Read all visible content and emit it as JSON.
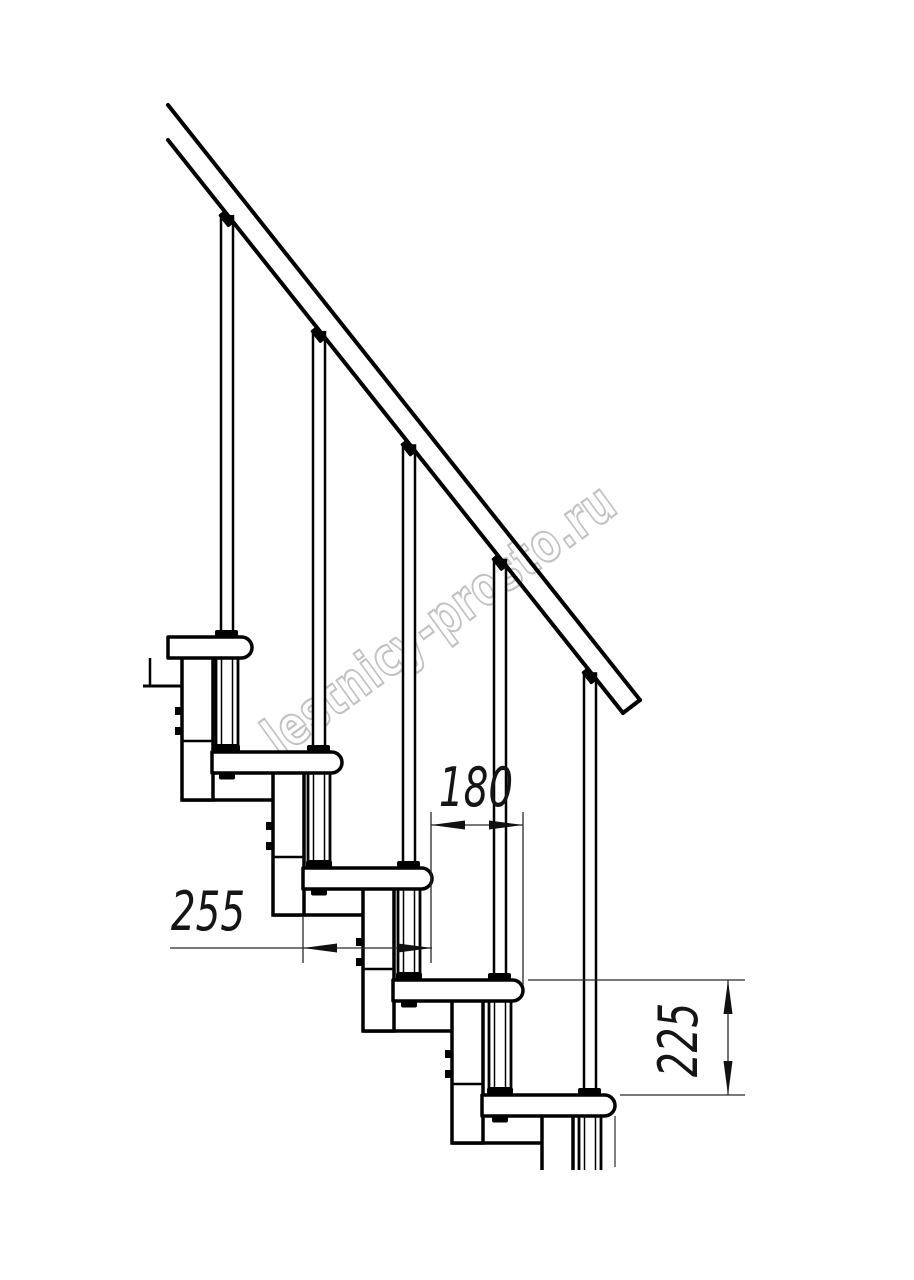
{
  "drawing": {
    "background": "#ffffff",
    "line_color": "#000000",
    "thin_line_color": "#2a2a2a",
    "watermark": {
      "text": "lestnicy-prosto.ru",
      "color": "#c2c2c2",
      "x": 280,
      "y": 758,
      "angle": -36,
      "squeeze": 0.75
    },
    "rail": {
      "x0": 168,
      "upper_y0": 105,
      "upper_x1": 640,
      "upper_y1": 700,
      "lower_y0": 140,
      "lower_x1": 623,
      "lower_y1": 713,
      "stroke": 4
    },
    "tread": {
      "height": 21,
      "end_radius": 10.5
    },
    "steps": [
      {
        "left": 168,
        "right": 252,
        "top": 637,
        "post_x": 227
      },
      {
        "left": 212,
        "right": 342,
        "top": 752,
        "post_x": 319
      },
      {
        "left": 303,
        "right": 432,
        "top": 868,
        "post_x": 409
      },
      {
        "left": 393,
        "right": 523,
        "top": 980,
        "post_x": 500
      },
      {
        "left": 482,
        "right": 615,
        "top": 1095,
        "post_x": 590
      }
    ],
    "module": {
      "column_width": 31,
      "top_offset": 20,
      "bottom_offset": 163,
      "divider_offset_above_next": 11,
      "ledge_length": 90,
      "tab_offsets": [
        70,
        90
      ],
      "tab_w": 7,
      "tab_h": 8
    },
    "cut_stubs": {
      "module5": {
        "x1": 542,
        "x2": 573,
        "y1": 1116,
        "y2": 1170
      },
      "tube5": {
        "cx": 590,
        "y1": 1116,
        "y2": 1170
      },
      "edge_line": {
        "x": 615,
        "y1": 1116,
        "y2": 1167
      },
      "remnant_ledge": {
        "x1": 143,
        "x2": 182,
        "y": 686
      },
      "remnant_post": {
        "x": 150,
        "y1": 658,
        "y2": 686
      }
    },
    "dimensions": {
      "dim_180": {
        "label": "180",
        "value_mm": 180,
        "text_x": 476,
        "text_y": 806,
        "line_y": 825,
        "from_x": 431,
        "to_x": 523,
        "ext_lines": [
          [
            431,
            812,
            963
          ],
          [
            523,
            812,
            985
          ]
        ]
      },
      "dim_255": {
        "label": "255",
        "value_mm": 255,
        "text_x": 208,
        "text_y": 930,
        "line_y": 948,
        "from_x": 303,
        "to_x": 432,
        "tail_x": 170,
        "ext_lines": [
          [
            303,
            916,
            963
          ]
        ]
      },
      "dim_225": {
        "label": "225",
        "value_mm": 225,
        "text_x": 697,
        "text_y": 1040,
        "line_x": 728,
        "from_y": 980,
        "to_y": 1095,
        "ext_top": [
          528,
          745,
          980
        ],
        "ext_bottom": [
          620,
          745,
          1095
        ]
      }
    }
  }
}
